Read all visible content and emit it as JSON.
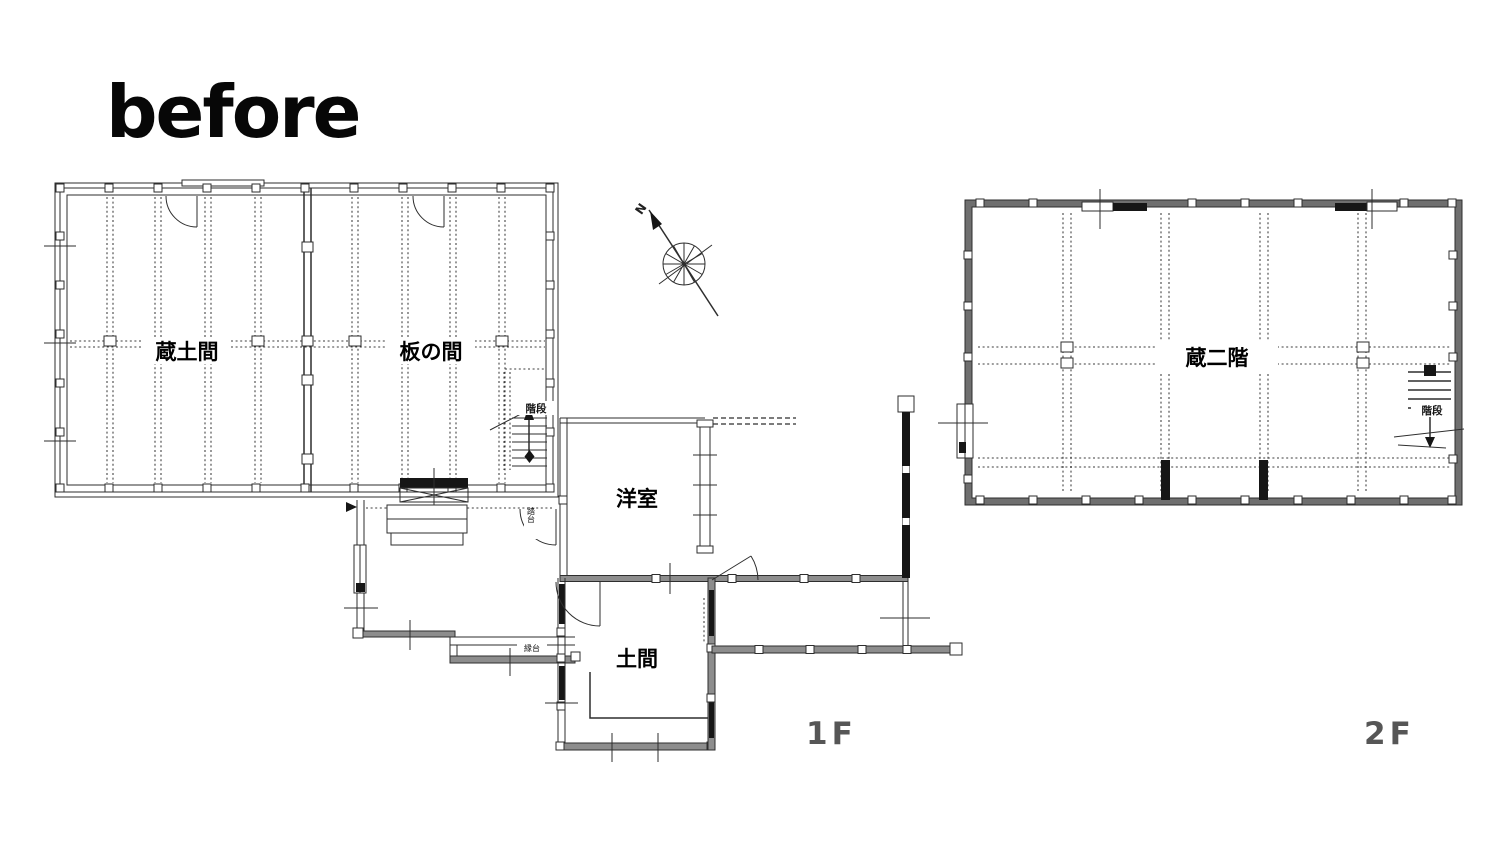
{
  "title": "before",
  "floor1": {
    "floor_label": "1F",
    "rooms": {
      "kura_doma": "蔵土間",
      "ita_no_ma": "板の間",
      "youshitsu": "洋室",
      "doma": "土間"
    },
    "stairs_label": "階段",
    "annotations": {
      "step_board": "踏台",
      "bench": "縁台"
    }
  },
  "floor2": {
    "floor_label": "2F",
    "rooms": {
      "kura_nikai": "蔵二階"
    },
    "stairs_label": "階段"
  },
  "compass": {
    "north": "N"
  },
  "colors": {
    "ink": "#2e2e2e",
    "wall_gray": "#8d8d8d",
    "wall_gray_2f": "#6f6f6f",
    "floor_label_gray": "#565656",
    "background": "#ffffff"
  }
}
